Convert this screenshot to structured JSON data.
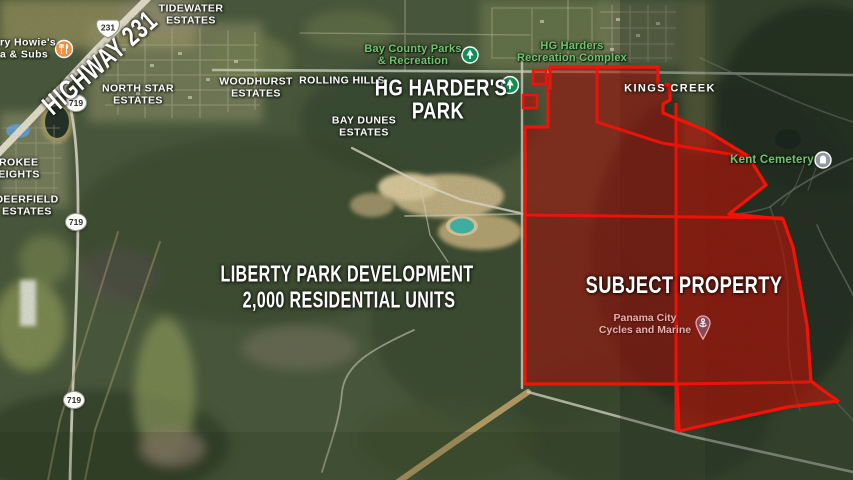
{
  "map": {
    "annotations": {
      "highway": "HIGHWAY 231",
      "hg_harders_park_line1": "HG HARDER'S",
      "hg_harders_park_line2": "PARK",
      "liberty_line1": "LIBERTY PARK DEVELOPMENT",
      "liberty_line2": "2,000 RESIDENTIAL UNITS",
      "subject_property": "SUBJECT PROPERTY"
    },
    "place_labels": {
      "tidewater_line1": "TIDEWATER",
      "tidewater_line2": "ESTATES",
      "woodhurst_line1": "WOODHURST",
      "woodhurst_line2": "ESTATES",
      "north_star_line1": "NORTH STAR",
      "north_star_line2": "ESTATES",
      "rolling_hills": "ROLLING HILLS",
      "bay_dunes_line1": "BAY DUNES",
      "bay_dunes_line2": "ESTATES",
      "kings_creek": "KINGS CREEK",
      "cherokee_line1": "EROKEE",
      "cherokee_line2": "HEIGHTS",
      "deerfield_line1": "DEERFIELD",
      "deerfield_line2": "ESTATES",
      "kent_cemetery": "Kent Cemetery",
      "bay_county_parks_line1": "Bay County Parks",
      "bay_county_parks_line2": "& Recreation",
      "hg_complex_line1": "HG Harders",
      "hg_complex_line2": "Recreation Complex",
      "panama_line1": "Panama City",
      "panama_line2": "Cycles and Marine",
      "howies_line1": "ry Howie's",
      "howies_line2": "a & Subs"
    },
    "shields": {
      "us231": "231",
      "fl719": "719"
    },
    "colors": {
      "subject_fill": "#A80E09",
      "subject_border": "#F31208",
      "annotation_text": "#FFFFFF",
      "poi_green": "#6EC56E",
      "business_pink": "#E5B2B0",
      "park_icon": "#0F8F55",
      "howies_icon": "#F08F3C",
      "cemetery_icon": "#8F99A3",
      "pin_icon": "#8A4656"
    }
  }
}
